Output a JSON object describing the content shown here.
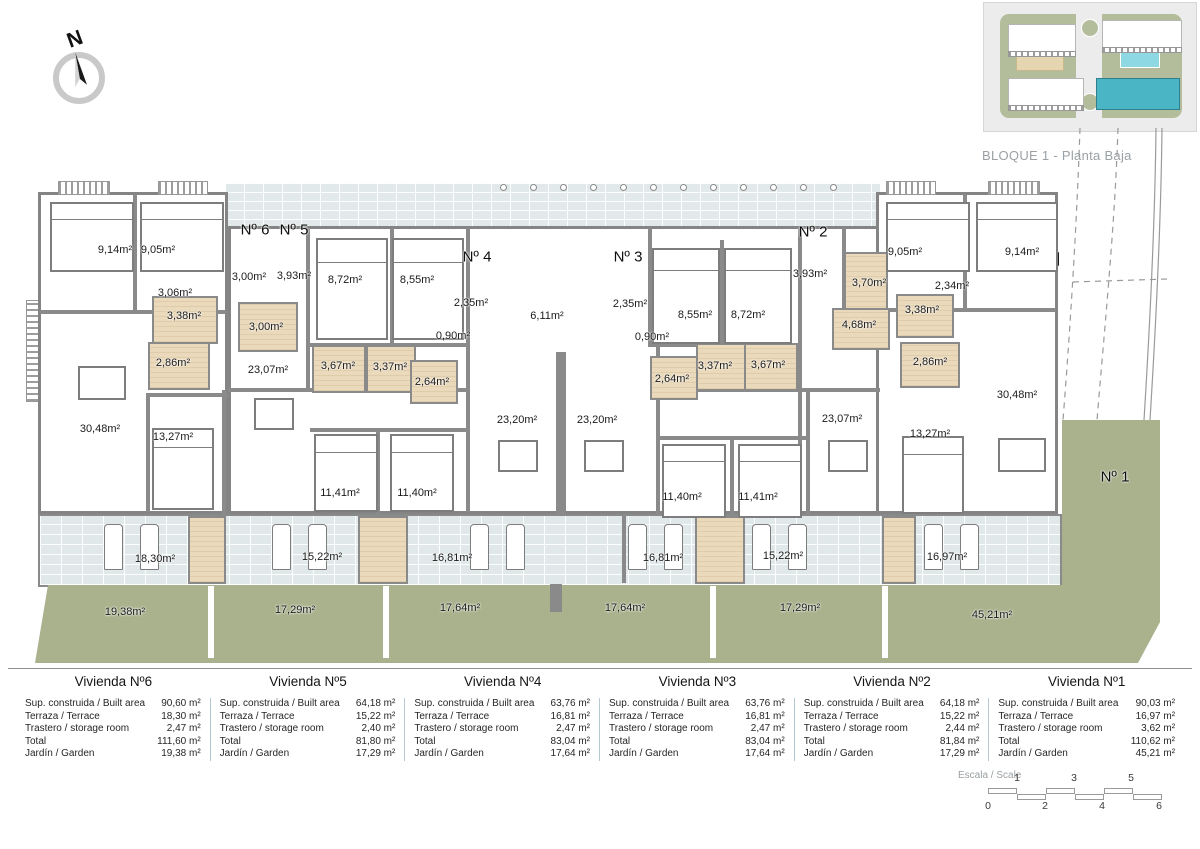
{
  "header": {
    "title": "BLOQUE 1 - Planta Baja"
  },
  "compass": {
    "letter": "N"
  },
  "plan": {
    "unit_labels": [
      {
        "text": "Nº 6",
        "x": 255,
        "y": 230
      },
      {
        "text": "Nº 5",
        "x": 294,
        "y": 230
      },
      {
        "text": "Nº 4",
        "x": 477,
        "y": 257
      },
      {
        "text": "Nº 3",
        "x": 628,
        "y": 257
      },
      {
        "text": "Nº 2",
        "x": 813,
        "y": 232
      },
      {
        "text": "Nº 1",
        "x": 1115,
        "y": 477
      }
    ],
    "area_labels": [
      {
        "text": "9,14m²",
        "x": 115,
        "y": 250
      },
      {
        "text": "9,05m²",
        "x": 158,
        "y": 250
      },
      {
        "text": "3,06m²",
        "x": 175,
        "y": 293
      },
      {
        "text": "3,38m²",
        "x": 184,
        "y": 316
      },
      {
        "text": "2,86m²",
        "x": 173,
        "y": 363
      },
      {
        "text": "3,00m²",
        "x": 249,
        "y": 277
      },
      {
        "text": "3,93m²",
        "x": 294,
        "y": 276
      },
      {
        "text": "3,00m²",
        "x": 266,
        "y": 327
      },
      {
        "text": "23,07m²",
        "x": 268,
        "y": 370
      },
      {
        "text": "8,72m²",
        "x": 345,
        "y": 280
      },
      {
        "text": "8,55m²",
        "x": 417,
        "y": 280
      },
      {
        "text": "2,35m²",
        "x": 471,
        "y": 303
      },
      {
        "text": "0,90m²",
        "x": 453,
        "y": 336
      },
      {
        "text": "6,11m²",
        "x": 547,
        "y": 316
      },
      {
        "text": "3,67m²",
        "x": 338,
        "y": 366
      },
      {
        "text": "3,37m²",
        "x": 390,
        "y": 367
      },
      {
        "text": "2,64m²",
        "x": 432,
        "y": 382
      },
      {
        "text": "2,35m²",
        "x": 630,
        "y": 304
      },
      {
        "text": "0,90m²",
        "x": 652,
        "y": 337
      },
      {
        "text": "8,55m²",
        "x": 695,
        "y": 315
      },
      {
        "text": "8,72m²",
        "x": 748,
        "y": 315
      },
      {
        "text": "2,64m²",
        "x": 672,
        "y": 379
      },
      {
        "text": "3,37m²",
        "x": 715,
        "y": 366
      },
      {
        "text": "3,67m²",
        "x": 768,
        "y": 365
      },
      {
        "text": "3,93m²",
        "x": 810,
        "y": 274
      },
      {
        "text": "3,70m²",
        "x": 869,
        "y": 283
      },
      {
        "text": "4,68m²",
        "x": 859,
        "y": 325
      },
      {
        "text": "9,05m²",
        "x": 905,
        "y": 252
      },
      {
        "text": "9,14m²",
        "x": 1022,
        "y": 252
      },
      {
        "text": "2,34m²",
        "x": 952,
        "y": 286
      },
      {
        "text": "3,38m²",
        "x": 922,
        "y": 310
      },
      {
        "text": "2,86m²",
        "x": 930,
        "y": 362
      },
      {
        "text": "30,48m²",
        "x": 100,
        "y": 429
      },
      {
        "text": "13,27m²",
        "x": 173,
        "y": 437
      },
      {
        "text": "11,41m²",
        "x": 340,
        "y": 493
      },
      {
        "text": "11,40m²",
        "x": 417,
        "y": 493
      },
      {
        "text": "23,20m²",
        "x": 517,
        "y": 420
      },
      {
        "text": "23,20m²",
        "x": 597,
        "y": 420
      },
      {
        "text": "11,40m²",
        "x": 682,
        "y": 497
      },
      {
        "text": "11,41m²",
        "x": 758,
        "y": 497
      },
      {
        "text": "23,07m²",
        "x": 842,
        "y": 419
      },
      {
        "text": "13,27m²",
        "x": 930,
        "y": 434
      },
      {
        "text": "30,48m²",
        "x": 1017,
        "y": 395
      },
      {
        "text": "18,30m²",
        "x": 155,
        "y": 559
      },
      {
        "text": "15,22m²",
        "x": 322,
        "y": 557
      },
      {
        "text": "16,81m²",
        "x": 452,
        "y": 558
      },
      {
        "text": "16,81m²",
        "x": 663,
        "y": 558
      },
      {
        "text": "15,22m²",
        "x": 783,
        "y": 556
      },
      {
        "text": "16,97m²",
        "x": 947,
        "y": 557
      },
      {
        "text": "19,38m²",
        "x": 125,
        "y": 612
      },
      {
        "text": "17,29m²",
        "x": 295,
        "y": 610
      },
      {
        "text": "17,64m²",
        "x": 460,
        "y": 608
      },
      {
        "text": "17,64m²",
        "x": 625,
        "y": 608
      },
      {
        "text": "17,29m²",
        "x": 800,
        "y": 608
      },
      {
        "text": "45,21m²",
        "x": 992,
        "y": 615
      }
    ]
  },
  "table": {
    "row_labels": [
      "Sup. construida / Built area",
      "Terraza / Terrace",
      "Trastero / storage room",
      "Total",
      "Jardín / Garden"
    ],
    "columns": [
      {
        "title": "Vivienda Nº6",
        "values": [
          "90,60 m²",
          "18,30 m²",
          "2,47 m²",
          "111,60 m²",
          "19,38 m²"
        ]
      },
      {
        "title": "Vivienda Nº5",
        "values": [
          "64,18 m²",
          "15,22 m²",
          "2,40 m²",
          "81,80 m²",
          "17,29 m²"
        ]
      },
      {
        "title": "Vivienda Nº4",
        "values": [
          "63,76 m²",
          "16,81 m²",
          "2,47 m²",
          "83,04 m²",
          "17,64 m²"
        ]
      },
      {
        "title": "Vivienda Nº3",
        "values": [
          "63,76 m²",
          "16,81 m²",
          "2,47 m²",
          "83,04 m²",
          "17,64 m²"
        ]
      },
      {
        "title": "Vivienda Nº2",
        "values": [
          "64,18 m²",
          "15,22 m²",
          "2,44 m²",
          "81,84 m²",
          "17,29 m²"
        ]
      },
      {
        "title": "Vivienda Nº1",
        "values": [
          "90,03 m²",
          "16,97 m²",
          "3,62 m²",
          "110,62 m²",
          "45,21 m²"
        ]
      }
    ]
  },
  "scale": {
    "caption": "Escala / Scale",
    "top_ticks": [
      "1",
      "3",
      "5"
    ],
    "bottom_ticks": [
      "0",
      "2",
      "4",
      "6"
    ]
  },
  "colors": {
    "wall": "#8a8a8a",
    "terrace": "#e0e8e9",
    "garden": "#a9b28d",
    "wet_room": "#ead9ba",
    "block_highlight": "#4ab5c5",
    "pool": "#8ed8e4",
    "title_gray": "#9aa0a4"
  }
}
